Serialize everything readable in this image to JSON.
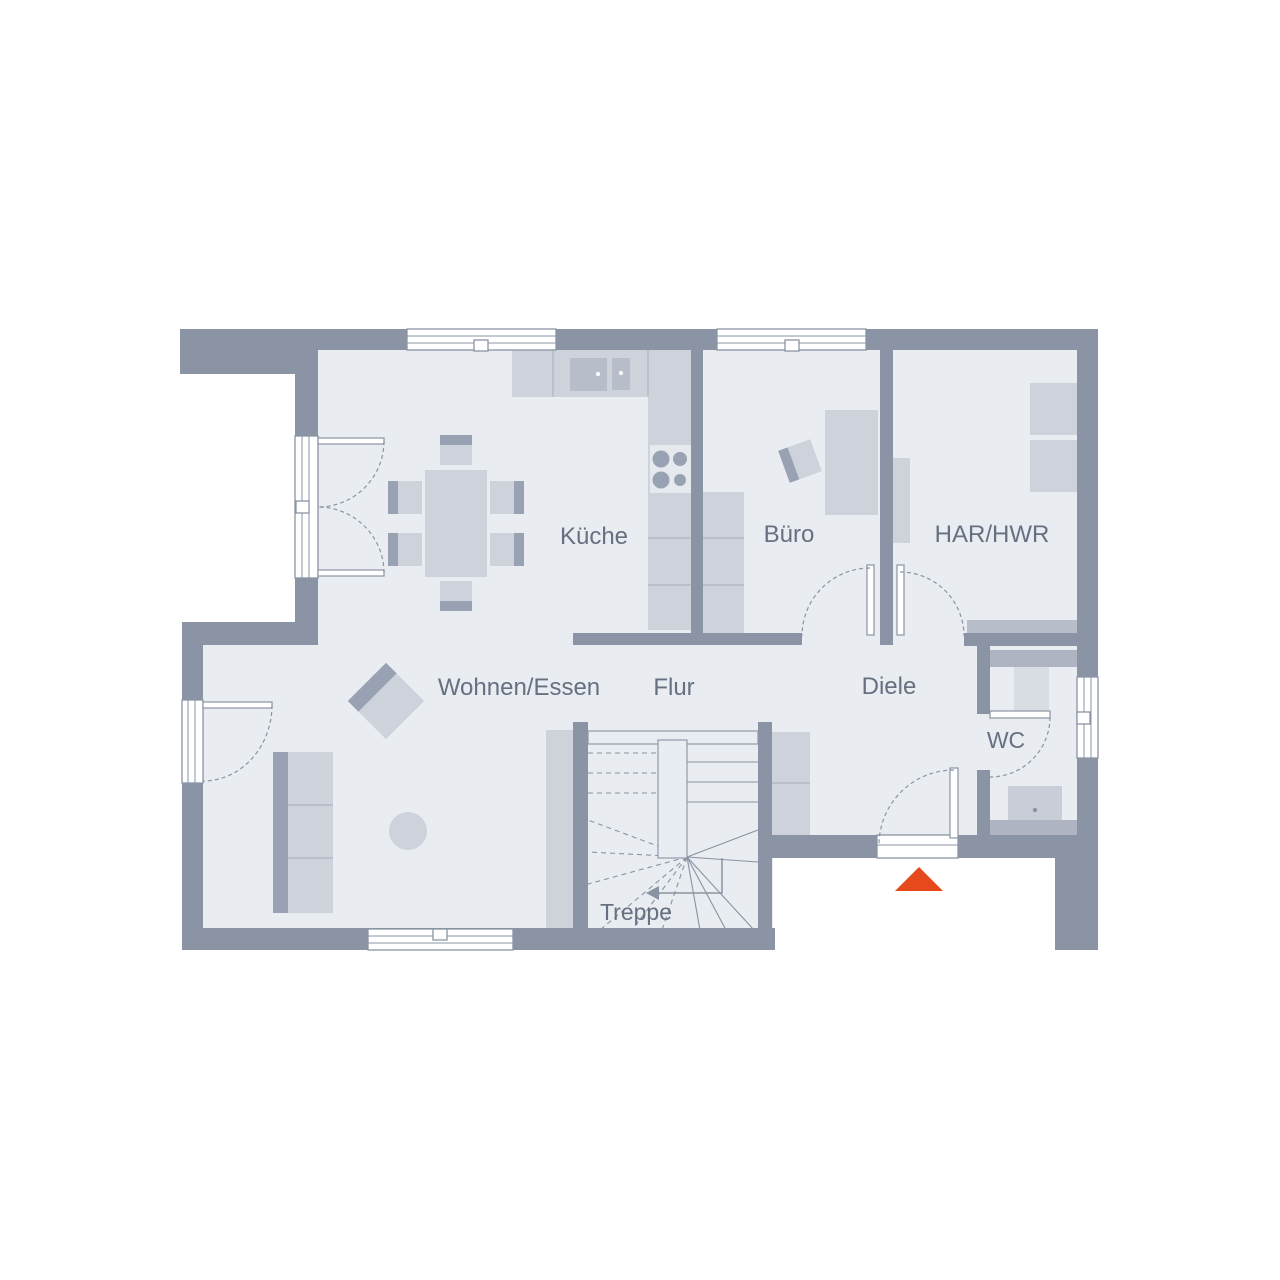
{
  "plan": {
    "type": "floorplan",
    "rooms": [
      {
        "id": "kueche",
        "label": "Küche"
      },
      {
        "id": "buero",
        "label": "Büro"
      },
      {
        "id": "har_hwr",
        "label": "HAR/HWR"
      },
      {
        "id": "wohnen_essen",
        "label": "Wohnen/Essen"
      },
      {
        "id": "flur",
        "label": "Flur"
      },
      {
        "id": "diele",
        "label": "Diele"
      },
      {
        "id": "wc",
        "label": "WC"
      },
      {
        "id": "treppe",
        "label": "Treppe"
      }
    ],
    "entrance_marker": {
      "shape": "triangle",
      "meaning": "entrance"
    },
    "colors": {
      "bg": "#ffffff",
      "floor": "#e9ecf1",
      "wall": "#8a94a4",
      "furn": "#cdd2db",
      "furn_dark": "#99a2b2",
      "fixture": "#b7bdc9",
      "band": "#aeb4c1",
      "stove": "#e6e9ee",
      "toilet": "#d8dce3",
      "sinkc": "#c8cdd7",
      "div": "#b4bac6",
      "stair": "#8a93a3",
      "text": "#667080",
      "accent": "#e5491c"
    }
  }
}
